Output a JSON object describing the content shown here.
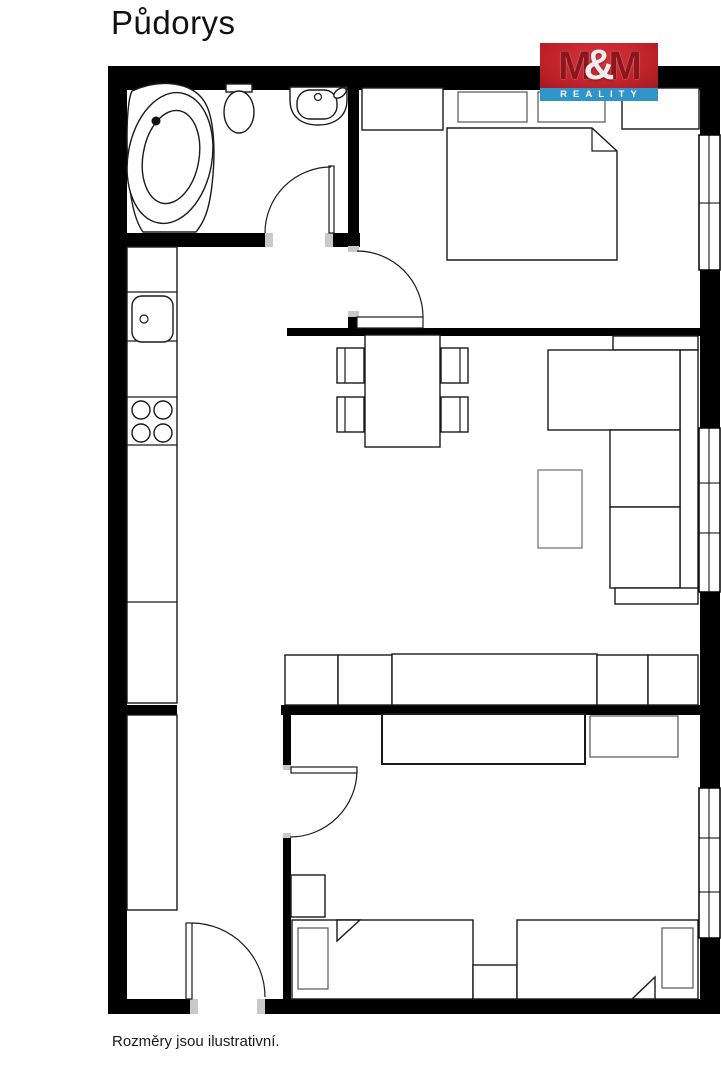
{
  "page": {
    "title": "Půdorys",
    "disclaimer": "Rozměry jsou ilustrativní.",
    "background": "#ffffff"
  },
  "logo": {
    "m1": "M",
    "amp": "&",
    "m2": "M",
    "word": "REALITY",
    "red": "#bb2029",
    "dark_red": "#8f151c",
    "blue": "#3094c8",
    "text_color": "#ffffff"
  },
  "floorplan": {
    "wall_color": "#000000",
    "door_jamb_color": "#c9c9c9",
    "rooms": [
      "bathroom",
      "bedroom",
      "kitchen-living-room",
      "entry-hall",
      "children-bedroom"
    ],
    "fixtures": [
      "bathtub",
      "toilet",
      "washbasin",
      "kitchen-counter",
      "kitchen-sink",
      "cooktop",
      "tall-cabinet",
      "dining-table",
      "dining-chairs",
      "corner-sofa",
      "coffee-table",
      "wardrobe-row",
      "double-bed",
      "pillows",
      "nightstands",
      "desk",
      "cabinet",
      "chair",
      "single-bed-left",
      "single-bed-right",
      "windows",
      "doors"
    ]
  }
}
